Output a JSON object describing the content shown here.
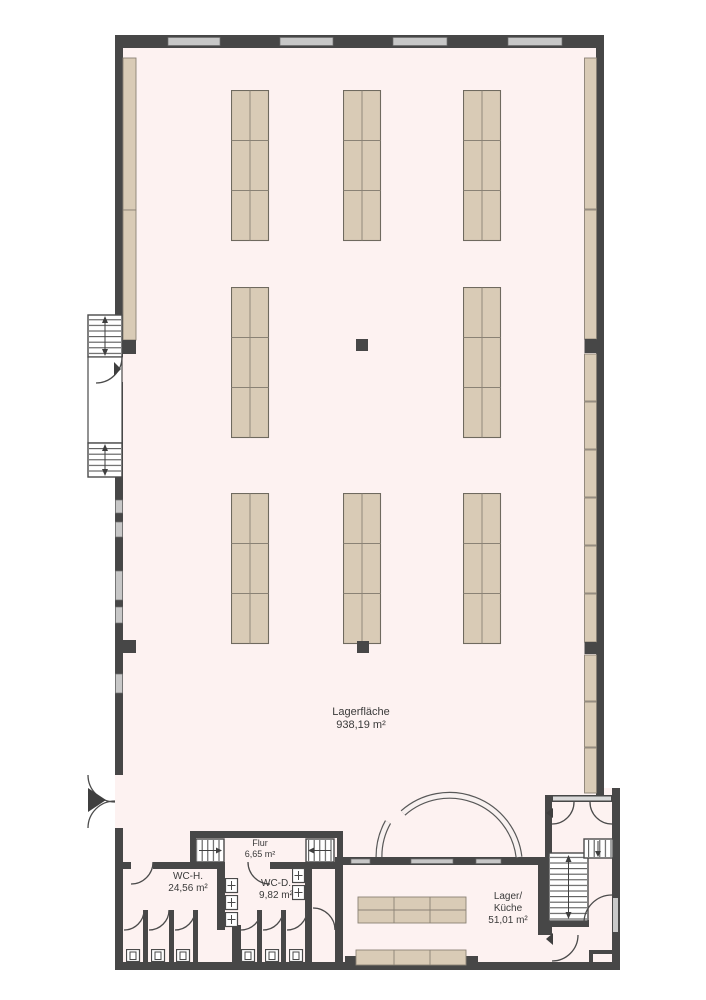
{
  "rooms": {
    "lagerflaeche": {
      "name": "Lagerfläche",
      "area": "938,19 m²"
    },
    "flur": {
      "name": "Flur",
      "area": "6,65 m²"
    },
    "wc_h": {
      "name": "WC-H.",
      "area": "24,56 m²"
    },
    "wc_d": {
      "name": "WC-D.",
      "area": "9,82 m²"
    },
    "lager_kueche": {
      "name_line1": "Lager/",
      "name_line2": "Küche",
      "area": "51,01 m²"
    }
  },
  "colors": {
    "wall": "#474747",
    "floor": "#fdf2f1",
    "shelf": "#d9cbb6",
    "shelfBorder": "#8a8275",
    "window": "#c7c7c7"
  }
}
